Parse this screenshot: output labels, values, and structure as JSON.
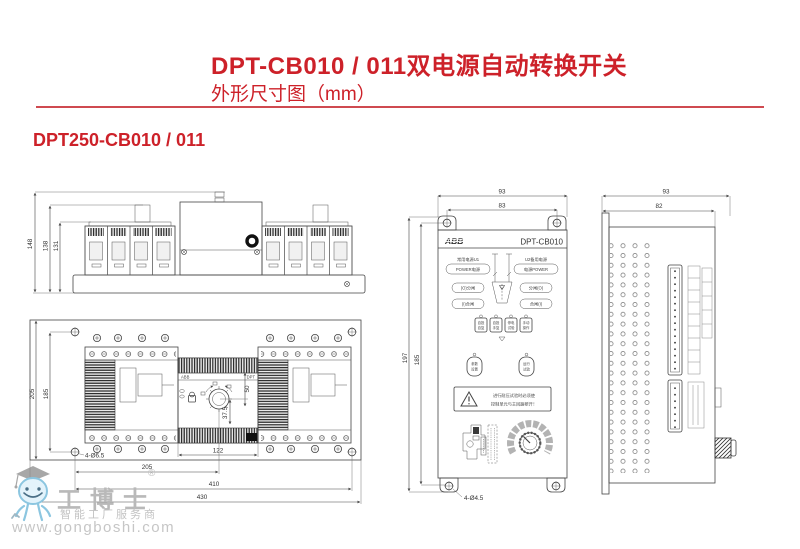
{
  "header": {
    "title": "DPT-CB010 / 011双电源自动转换开关",
    "subtitle": "外形尺寸图（mm）"
  },
  "section": {
    "heading": "DPT250-CB010 / 011"
  },
  "front_view": {
    "h_overall": "148",
    "h_mid": "138",
    "h_inner": "131"
  },
  "top_view": {
    "v_outer": "205",
    "v_inner": "185",
    "w_center": "205",
    "w_mount": "410",
    "w_overall": "430",
    "w_mech": "122",
    "d_offset": "37.5",
    "d_height": "50",
    "holes": "4-Ø6.5",
    "brand": "ABB",
    "mech": "DPT"
  },
  "controller": {
    "w_overall": "93",
    "w_mount": "83",
    "h_overall": "197",
    "h_mount": "185",
    "holes": "4-Ø4.5",
    "brand": "ABB",
    "model": "DPT-CB010",
    "src_left": "常用电源U1",
    "src_right": "U2备用电源",
    "power_left": "POWER电源",
    "power_right": "电源POWER",
    "open_left": "(O)分闸",
    "open_right": "分闸(O)",
    "close_left": "(I)合闸",
    "close_right": "合闸(I)",
    "buttons": [
      {
        "a": "自投",
        "b": "自复"
      },
      {
        "a": "自投",
        "b": "手复"
      },
      {
        "a": "停电",
        "b": "试验"
      },
      {
        "a": "手动",
        "b": "操作"
      }
    ],
    "fn_buttons": [
      {
        "a": "参数",
        "b": "设置"
      },
      {
        "a": "运行",
        "b": "试验"
      }
    ],
    "warn1": "进行耐压试验时必须使",
    "warn2": "控制单元与主回路断开！"
  },
  "side_view": {
    "d_overall": "93",
    "d_inner": "82"
  },
  "watermark": {
    "name": "工博士",
    "reg": "®",
    "tagline": "智能工厂服务商",
    "url": "www.gongboshi.com"
  }
}
